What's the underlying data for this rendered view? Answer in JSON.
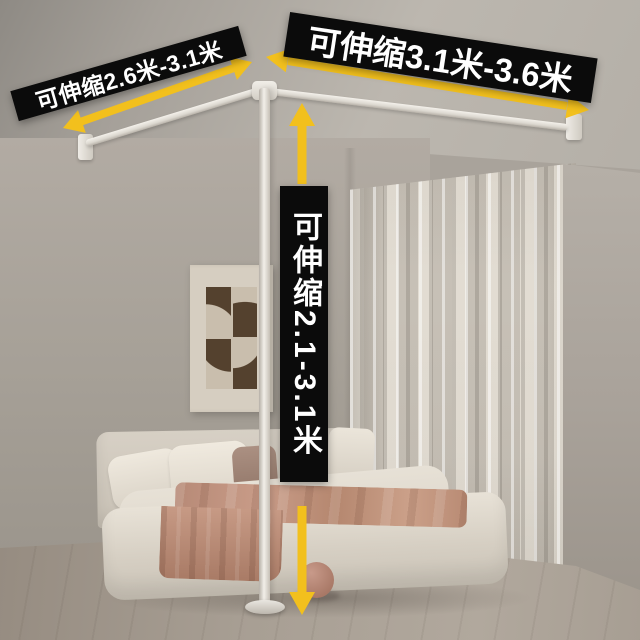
{
  "annotations": {
    "left_rod_label": "可伸缩2.6米-3.1米",
    "top_rod_label": "可伸缩3.1米-3.6米",
    "pole_label": "可伸缩2.1-3.1米"
  },
  "measurements": {
    "left_rod_range_meters": [
      2.6,
      3.1
    ],
    "top_rod_range_meters": [
      3.1,
      3.6
    ],
    "pole_height_range_meters": [
      2.1,
      3.1
    ]
  },
  "colors": {
    "banner_bg": "#0b0b0b",
    "banner_text": "#ffffff",
    "arrow": "#f2c01d"
  }
}
